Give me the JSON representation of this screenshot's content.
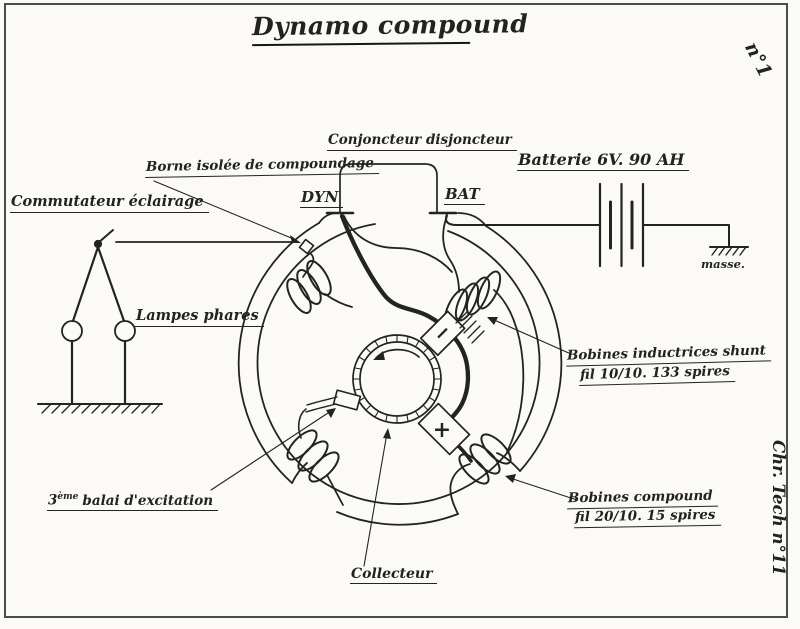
{
  "document": {
    "title": "Dynamo compound",
    "sheet_number": "n°1",
    "signature": "Chr. Tech n°11"
  },
  "labels": {
    "conjoncteur": "Conjoncteur disjoncteur",
    "terminal_dyn": "DYN",
    "terminal_bat": "BAT",
    "batterie": "Batterie 6V. 90 AH",
    "masse": "masse.",
    "borne_compoundage": "Borne isolée de compoundage",
    "commutateur_eclairage": "Commutateur éclairage",
    "lampes_phares": "Lampes phares",
    "bobines_shunt_l1": "Bobines inductrices shunt",
    "bobines_shunt_l2": "fil 10/10. 133 spires",
    "bobines_compound_l1": "Bobines compound",
    "bobines_compound_l2": "fil 20/10. 15 spires",
    "troisieme_balai_num": "3",
    "troisieme_balai_sup": "ème",
    "troisieme_balai_rest": "balai d'excitation",
    "collecteur": "Collecteur",
    "polarity_plus": "+",
    "polarity_minus": "−"
  },
  "colors": {
    "ink": "#232323",
    "frame": "#474c50",
    "paper": "#fbfaf6"
  }
}
